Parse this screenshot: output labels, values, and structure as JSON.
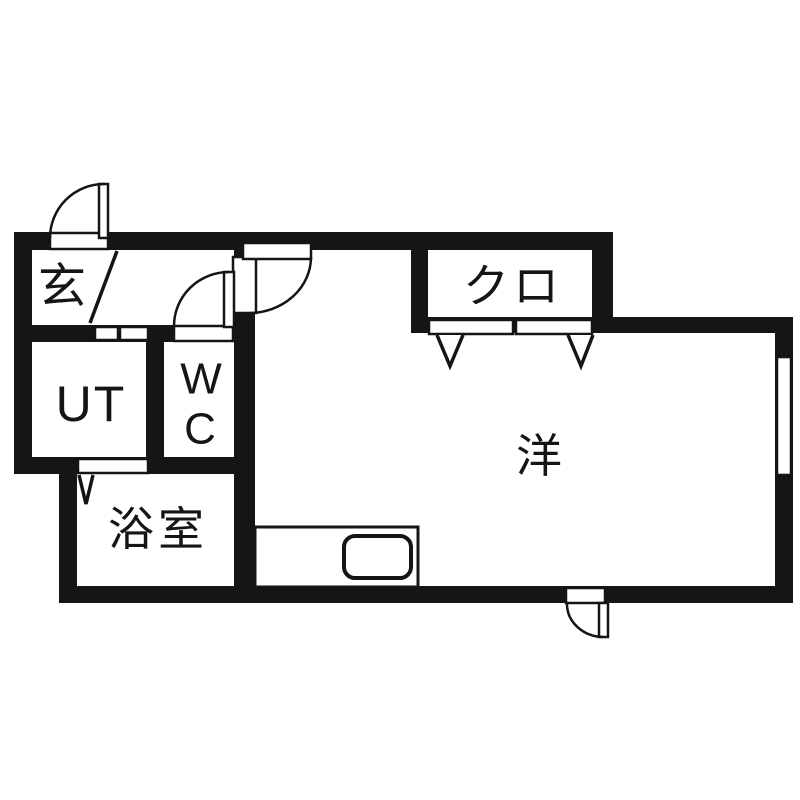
{
  "meta": {
    "description": "Japanese apartment floor plan (1R layout)",
    "background_color": "#ffffff",
    "wall_color": "#151515",
    "text_color": "#151515"
  },
  "rooms": {
    "genkan": {
      "label": "玄"
    },
    "closet": {
      "label": "クロ"
    },
    "utility": {
      "label": "UT"
    },
    "toilet": {
      "line1": "W",
      "line2": "C"
    },
    "bathroom": {
      "label": "浴室"
    },
    "main_room": {
      "label": "洋"
    }
  },
  "fixtures": [
    "entrance-swing-door",
    "toilet-swing-door",
    "room-swing-door",
    "balcony-swing-door",
    "utility-sliding-door",
    "bathroom-folding-door",
    "closet-bifold-doors",
    "kitchen-counter",
    "kitchen-sink",
    "window"
  ]
}
